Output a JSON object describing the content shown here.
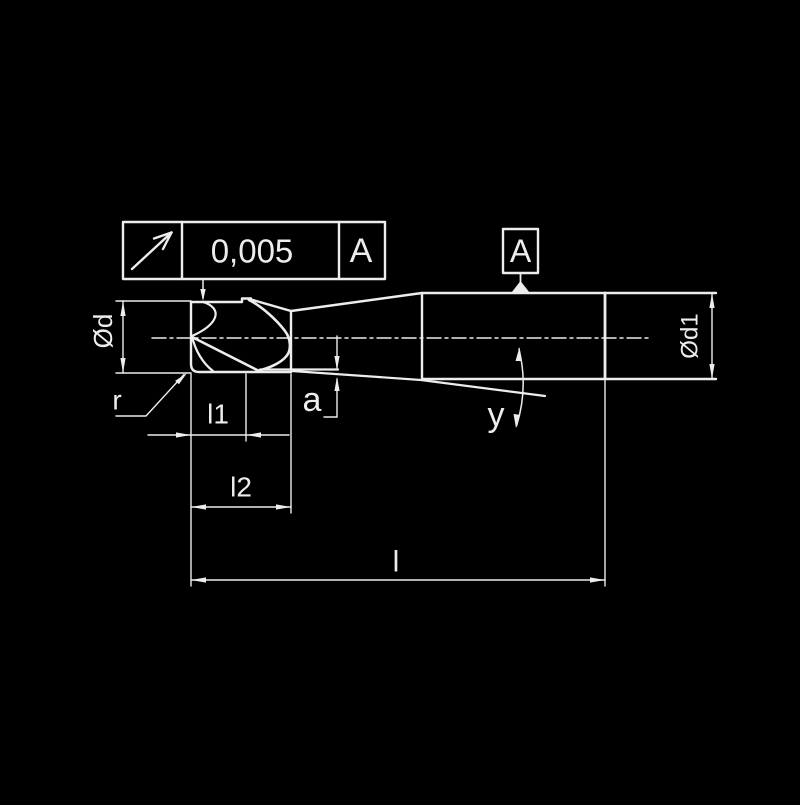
{
  "drawing": {
    "tolerance_frame": {
      "symbol": "circular-runout",
      "value": "0,005",
      "datum": "A"
    },
    "datum_flag": {
      "label": "A"
    },
    "dimension_labels": {
      "diameter_head": "Ød",
      "diameter_shank": "Ød1",
      "corner_radius": "r",
      "cut_length": "l1",
      "flute_length": "l2",
      "overall_length": "l",
      "edge_offset": "a",
      "taper_angle": "y"
    },
    "colors": {
      "background": "#000000",
      "line": "#ededed"
    }
  }
}
